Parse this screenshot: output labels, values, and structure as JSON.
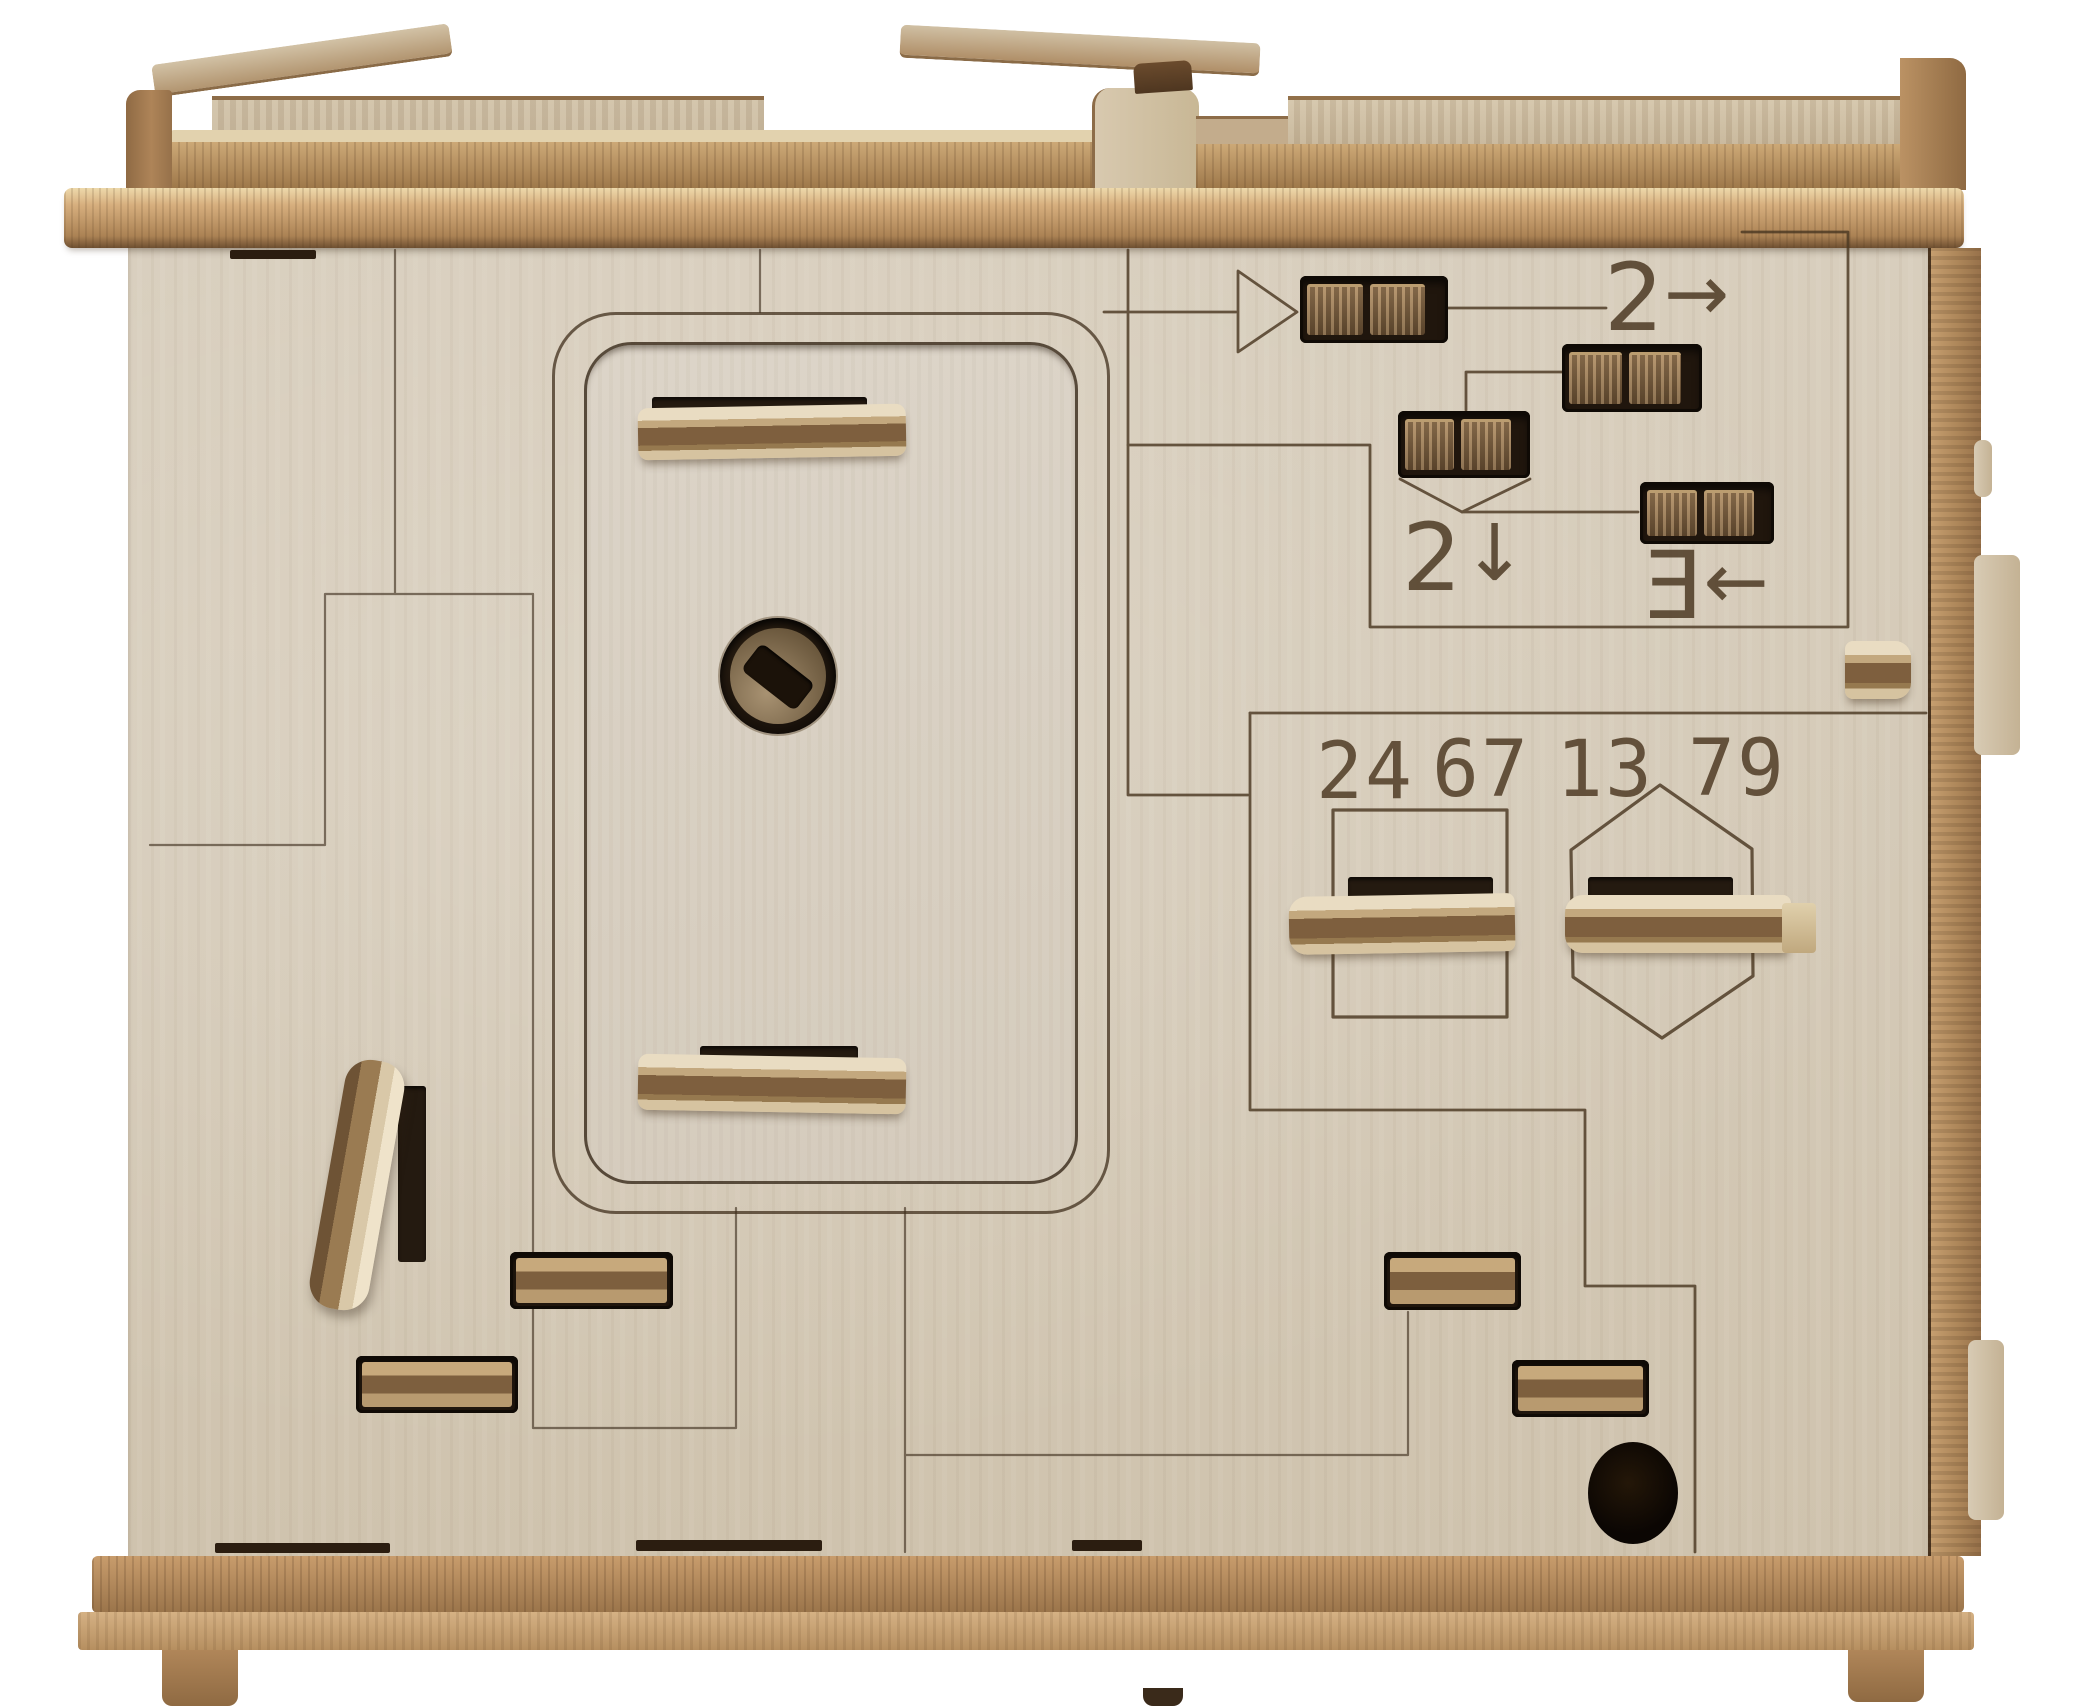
{
  "scene": {
    "description": "Front view photo of a laser-cut plywood escape-puzzle box with engraved circuit-style lines, slider switches, a rounded hatch door with slotted screw, lever tabs under a square and a hexagon, and engraved code numbers",
    "background": "#ffffff"
  },
  "colors": {
    "panel_wood": "#d5cbb9",
    "edge_wood": "#a87f52",
    "engraving": "#4b3822",
    "slot_recess": "#20160d",
    "slider_wood": "#8a6a45",
    "cap_highlight": "#eed9ab",
    "hole_black": "#0b0603"
  },
  "engravings": {
    "digits": [
      "24",
      "67",
      "13",
      "79"
    ],
    "sequence_labels": [
      {
        "name": "start-triangle",
        "glyph": "▷"
      },
      {
        "name": "step-two-right",
        "digit": "2",
        "arrow": "→"
      },
      {
        "name": "step-two-down",
        "digit": "2",
        "arrow": "↓"
      },
      {
        "name": "step-three-left",
        "digit": "Ǝ",
        "arrow": "←"
      }
    ],
    "shapes": [
      "square-outline",
      "hexagon-outline"
    ]
  }
}
